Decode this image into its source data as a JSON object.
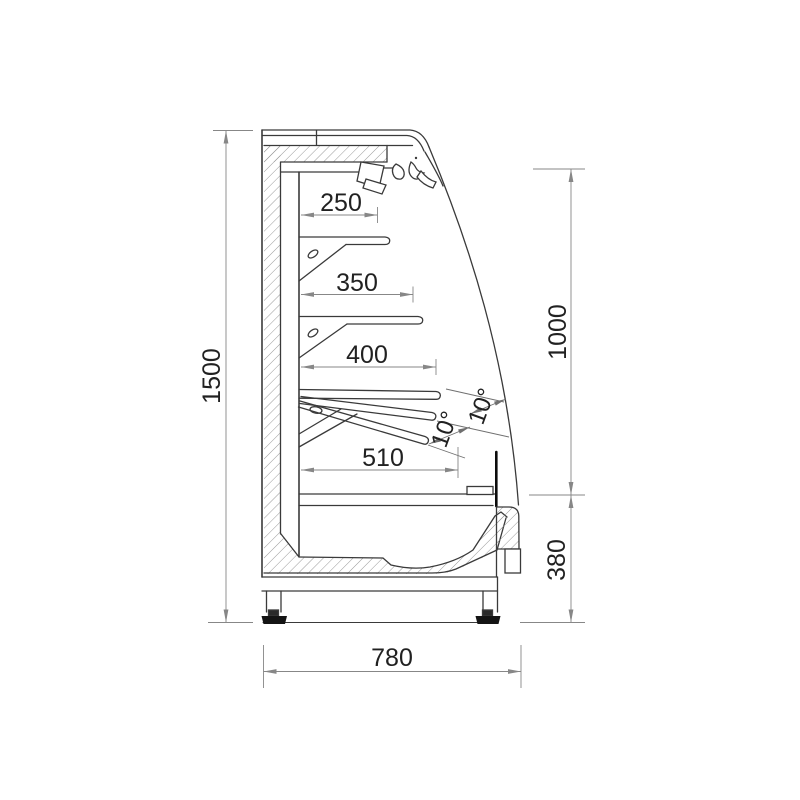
{
  "drawing": {
    "type": "technical-section",
    "subject": "open refrigerated display case, side cross-section with dimensions",
    "dimensions": {
      "shelf1_depth": "250",
      "shelf2_depth": "350",
      "shelf3_depth": "400",
      "deck_depth": "510",
      "overall_depth": "780",
      "overall_height": "1500",
      "opening_height": "1000",
      "base_height": "380",
      "tilt_angle_a": "10°",
      "tilt_angle_b": "10°"
    },
    "colors": {
      "background": "#ffffff",
      "object_line": "#3a3a3a",
      "dimension_line": "#878787",
      "text": "#212121",
      "hatch": "#8f8f8f",
      "solid_black": "#141414"
    }
  }
}
